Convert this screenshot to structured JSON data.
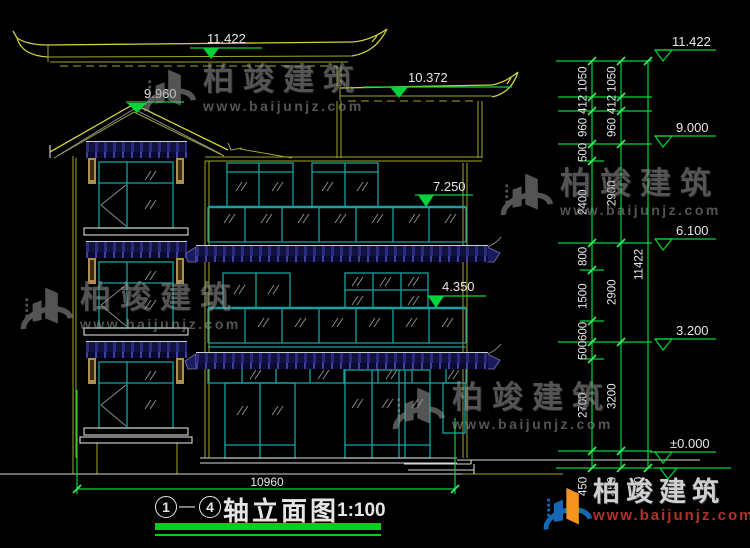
{
  "colors": {
    "background": "#000000",
    "line_olive": "#9fa52b",
    "line_bright": "#cdd23d",
    "line_teal": "#17a2a2",
    "line_white": "#d9d9d9",
    "dim_green": "#00d43a",
    "tile_navy": "#14144a",
    "bracket_tan": "#b08e52",
    "text_white": "#e6e6e6",
    "watermark_gray": "#9a9a9a",
    "logo_blue": "#1668b5",
    "logo_orange": "#f7941d",
    "logo_red": "#b03328",
    "title_green": "#00cf1b"
  },
  "title_block": {
    "axis_start": "1",
    "axis_separator": "—",
    "axis_end": "4",
    "name": "轴立面图",
    "scale": "1:100"
  },
  "dimensions": {
    "overall_width": "10960",
    "left_markers": {
      "main_ridge": "11.422",
      "gable_ridge": "9.960",
      "secondary_roof": "10.372",
      "third_balcony": "7.250",
      "second_balcony": "4.350"
    },
    "right_elevations": {
      "roof": "11.422",
      "third_floor": "9.000",
      "second_floor": "6.100",
      "first_floor": "3.200",
      "ground": "±0.000"
    },
    "chain_inner": [
      "1050",
      "412",
      "960",
      "500",
      "2400",
      "800",
      "1500",
      "600",
      "500",
      "2700"
    ],
    "chain_middle": [
      "1050",
      "412",
      "960",
      "2900",
      "2900",
      "3200"
    ],
    "chain_total": "11422",
    "below_ground": [
      "450",
      "450",
      "450"
    ]
  },
  "watermark": {
    "brand": "柏竣建筑",
    "url": "www.baijunjz.com"
  },
  "logo": {
    "brand": "柏竣建筑",
    "url": "www.baijunjz.com"
  }
}
